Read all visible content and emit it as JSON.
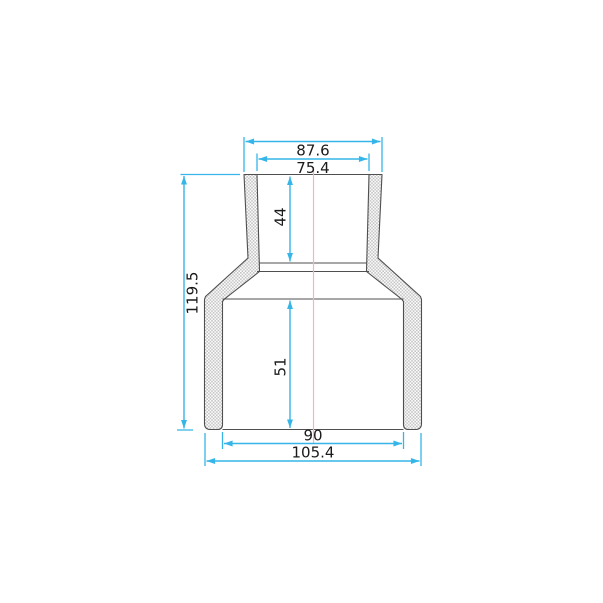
{
  "drawing": {
    "kind": "dimensioned cross-section drawing of a concentric reducer pipe fitting",
    "dims": {
      "top_outer_width": "87.6",
      "top_inner_width": "75.4",
      "top_socket_depth": "44",
      "overall_height": "119.5",
      "bottom_socket_depth": "51",
      "bottom_inner_width": "90",
      "bottom_outer_width": "105.4"
    },
    "colors": {
      "background": "#ffffff",
      "dimension_lines": "#35b5e8",
      "center_line": "#f0b6b6",
      "part_outline": "#4f4f4f",
      "hatch_fill": "#c3c3c3",
      "label_text": "#1a1a1a"
    }
  }
}
